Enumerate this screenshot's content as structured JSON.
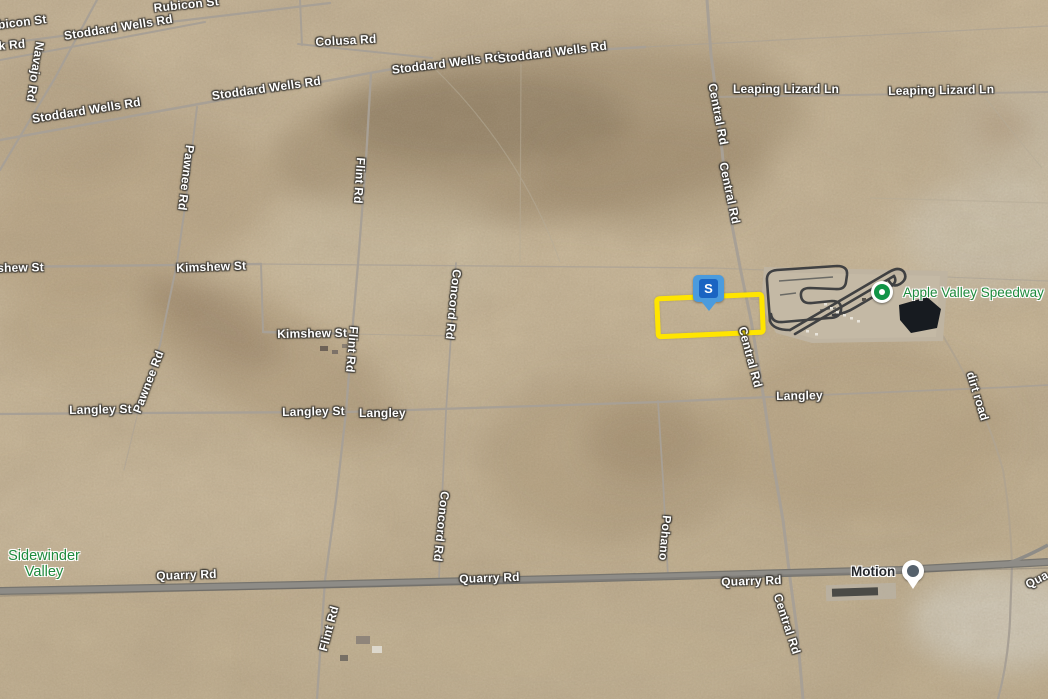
{
  "labels": [
    {
      "name": "rubicon-st",
      "text": "Rubicon St"
    },
    {
      "name": "rubicon-st-partial",
      "text": "bicon St"
    },
    {
      "name": "k-rd-partial",
      "text": "k Rd"
    },
    {
      "name": "stoddard-wells-rd-1",
      "text": "Stoddard Wells Rd"
    },
    {
      "name": "stoddard-wells-rd-2",
      "text": "Stoddard Wells Rd"
    },
    {
      "name": "stoddard-wells-rd-3",
      "text": "Stoddard Wells Rd"
    },
    {
      "name": "stoddard-wells-rd-4",
      "text": "Stoddard Wells Rd"
    },
    {
      "name": "stoddard-wells-rd-5",
      "text": "Stoddard Wells Rd"
    },
    {
      "name": "colusa-rd",
      "text": "Colusa Rd"
    },
    {
      "name": "leaping-lizard-ln-1",
      "text": "Leaping Lizard Ln"
    },
    {
      "name": "leaping-lizard-ln-2",
      "text": "Leaping Lizard Ln"
    },
    {
      "name": "kimshew-st-partial",
      "text": "shew St"
    },
    {
      "name": "kimshew-st-1",
      "text": "Kimshew St"
    },
    {
      "name": "kimshew-st-2",
      "text": "Kimshew St"
    },
    {
      "name": "langley-st-1",
      "text": "Langley St"
    },
    {
      "name": "langley-st-2",
      "text": "Langley St"
    },
    {
      "name": "langley-1",
      "text": "Langley"
    },
    {
      "name": "langley-2",
      "text": "Langley"
    },
    {
      "name": "quarry-rd-1",
      "text": "Quarry Rd"
    },
    {
      "name": "quarry-rd-2",
      "text": "Quarry Rd"
    },
    {
      "name": "quarry-rd-3",
      "text": "Quarry Rd"
    },
    {
      "name": "quarry-rd-partial",
      "text": "Qua"
    },
    {
      "name": "navajo-rd",
      "text": "Navajo Rd"
    },
    {
      "name": "navajo-rd-partial",
      "text": "ajo Rd"
    },
    {
      "name": "pawnee-rd-1",
      "text": "Pawnee Rd"
    },
    {
      "name": "pawnee-rd-2",
      "text": "Pawnee Rd"
    },
    {
      "name": "flint-rd-1",
      "text": "Flint Rd"
    },
    {
      "name": "flint-rd-2",
      "text": "Flint Rd"
    },
    {
      "name": "flint-rd-3",
      "text": "Flint Rd"
    },
    {
      "name": "concord-rd-1",
      "text": "Concord Rd"
    },
    {
      "name": "concord-rd-2",
      "text": "Concord Rd"
    },
    {
      "name": "central-rd-1",
      "text": "Central Rd"
    },
    {
      "name": "central-rd-2",
      "text": "Central Rd"
    },
    {
      "name": "central-rd-3",
      "text": "Central Rd"
    },
    {
      "name": "central-rd-4",
      "text": "Central Rd"
    },
    {
      "name": "pohano",
      "text": "Pohano"
    },
    {
      "name": "dirt-road",
      "text": "dirt road"
    }
  ],
  "poi": {
    "sidewinder_valley": {
      "line1": "Sidewinder",
      "line2": "Valley"
    },
    "apple_valley_speedway": {
      "label": "Apple Valley Speedway"
    },
    "motion": {
      "label": "Motion"
    }
  },
  "markers": {
    "s": {
      "letter": "S"
    }
  },
  "colors": {
    "parcel_outline": "#FFE500",
    "s_marker_frame": "#4B9BDD",
    "s_marker_inner": "#1A64C2",
    "poi_green": "#1e8a3c",
    "motion_pin_gray": "#55616C",
    "road_gray": "#a8a095",
    "highway_gray": "#8e8c87"
  }
}
